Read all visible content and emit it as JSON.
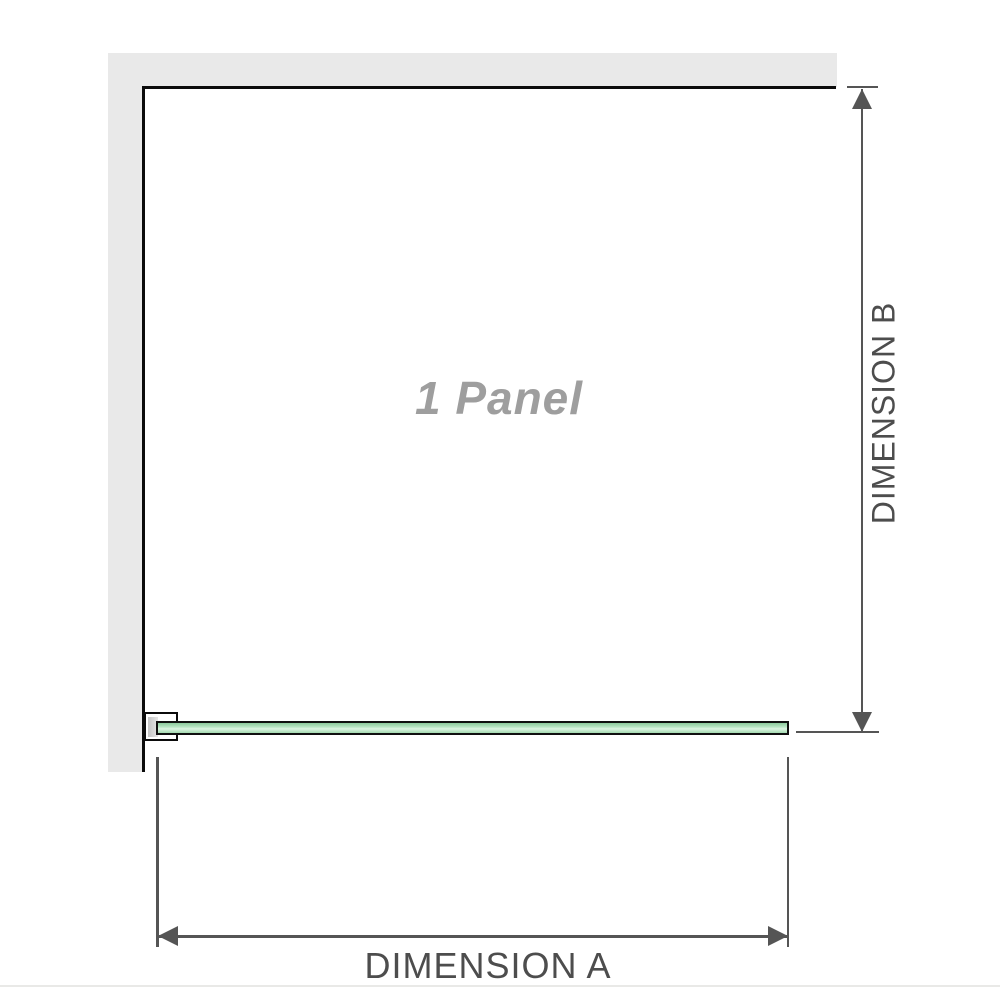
{
  "diagram": {
    "panel_label": "1 Panel",
    "dimension_a_label": "DIMENSION A",
    "dimension_b_label": "DIMENSION B",
    "icons": {
      "arrow_up": "arrow-up-icon",
      "arrow_down": "arrow-down-icon",
      "arrow_left": "arrow-left-icon",
      "arrow_right": "arrow-right-icon"
    },
    "colors": {
      "wall_gray": "#e9e9e9",
      "panel_outline_black": "#0b0b0b",
      "dimension_line_gray": "#555555",
      "dimension_text_gray": "#4d4d4d",
      "panel_label_gray": "#9e9e9e",
      "glass_green_top": "#8cca9c",
      "glass_green_highlight": "#def4e3",
      "glass_green_bottom": "#a3dab0",
      "bracket_pad_gray": "#c4c4c4",
      "bottom_divider_gray": "#e9e9e7"
    }
  }
}
